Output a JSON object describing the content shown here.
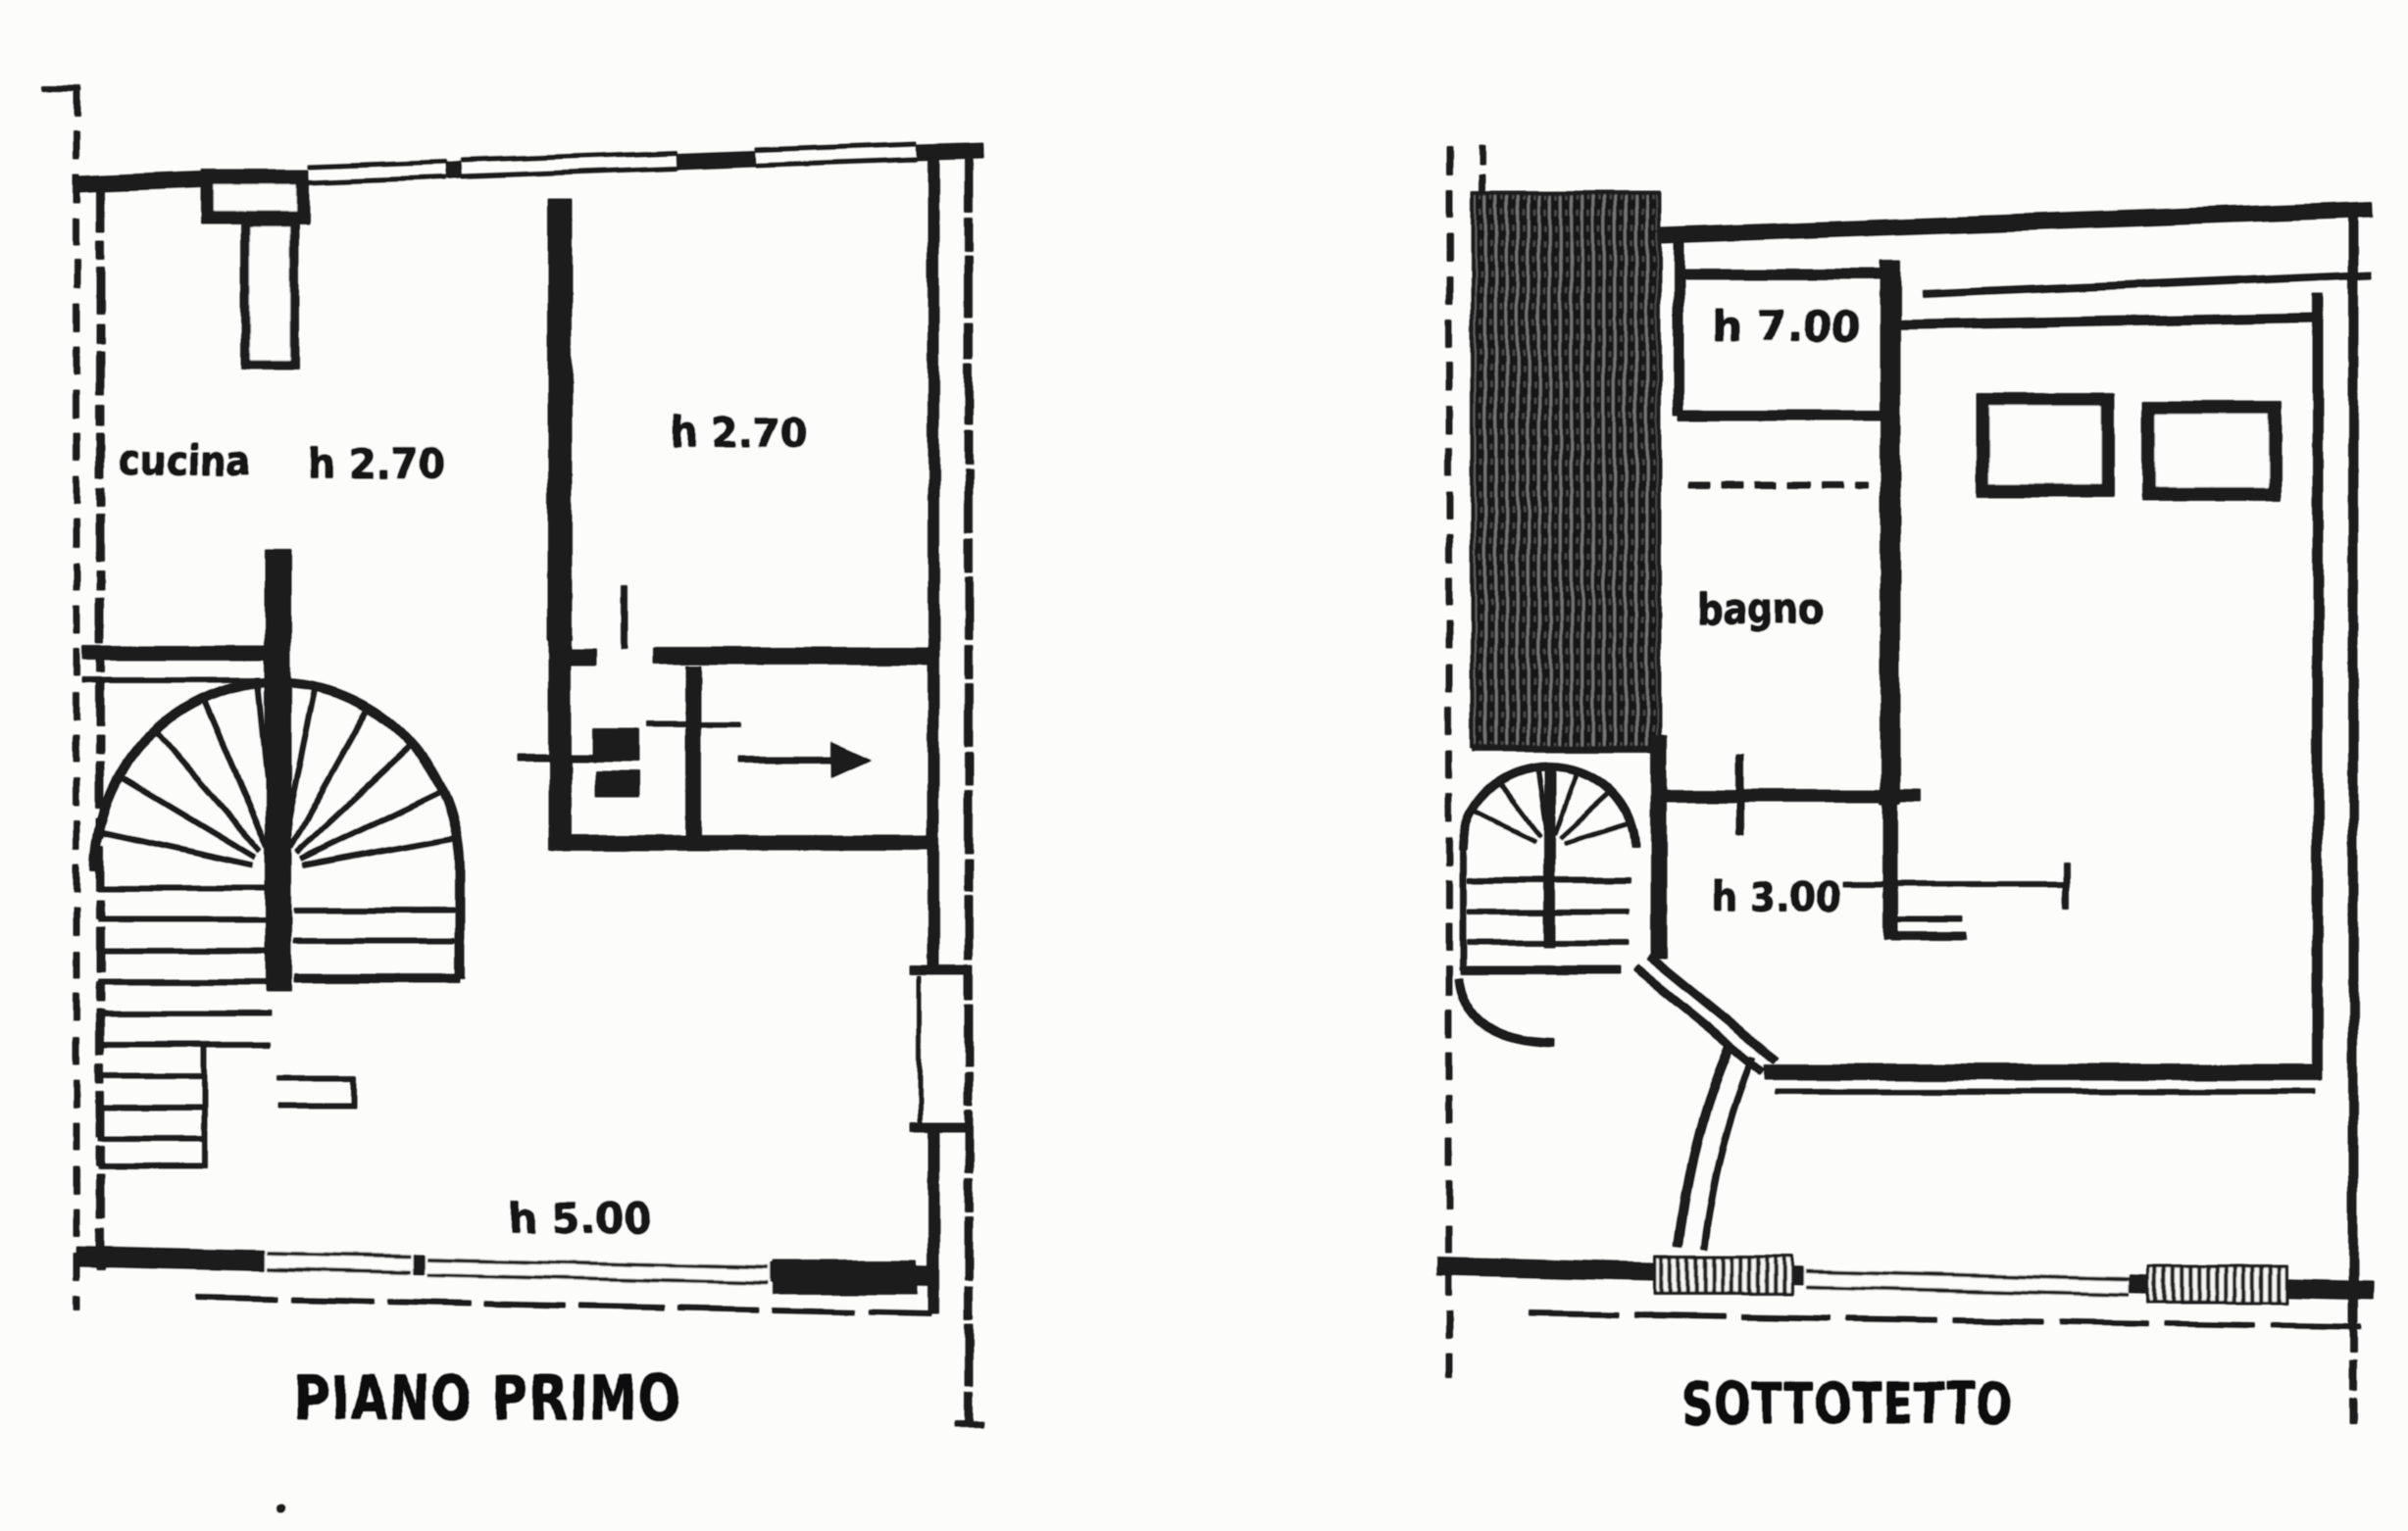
{
  "document": {
    "ink_color": "#1a1a1a",
    "paper_color": "#fcfcfb"
  },
  "plans": [
    {
      "title": "PIANO PRIMO",
      "labels": {
        "kitchen_label": "cucina",
        "kitchen_height": "h 2.70",
        "adjacent_room_height": "h 2.70",
        "lower_room_height": "h 5.00"
      }
    },
    {
      "title": "SOTTOTETTO",
      "labels": {
        "attic_room_height": "h 7.00",
        "bathroom_label": "bagno",
        "stair_room_height": "h 3.00"
      }
    }
  ]
}
